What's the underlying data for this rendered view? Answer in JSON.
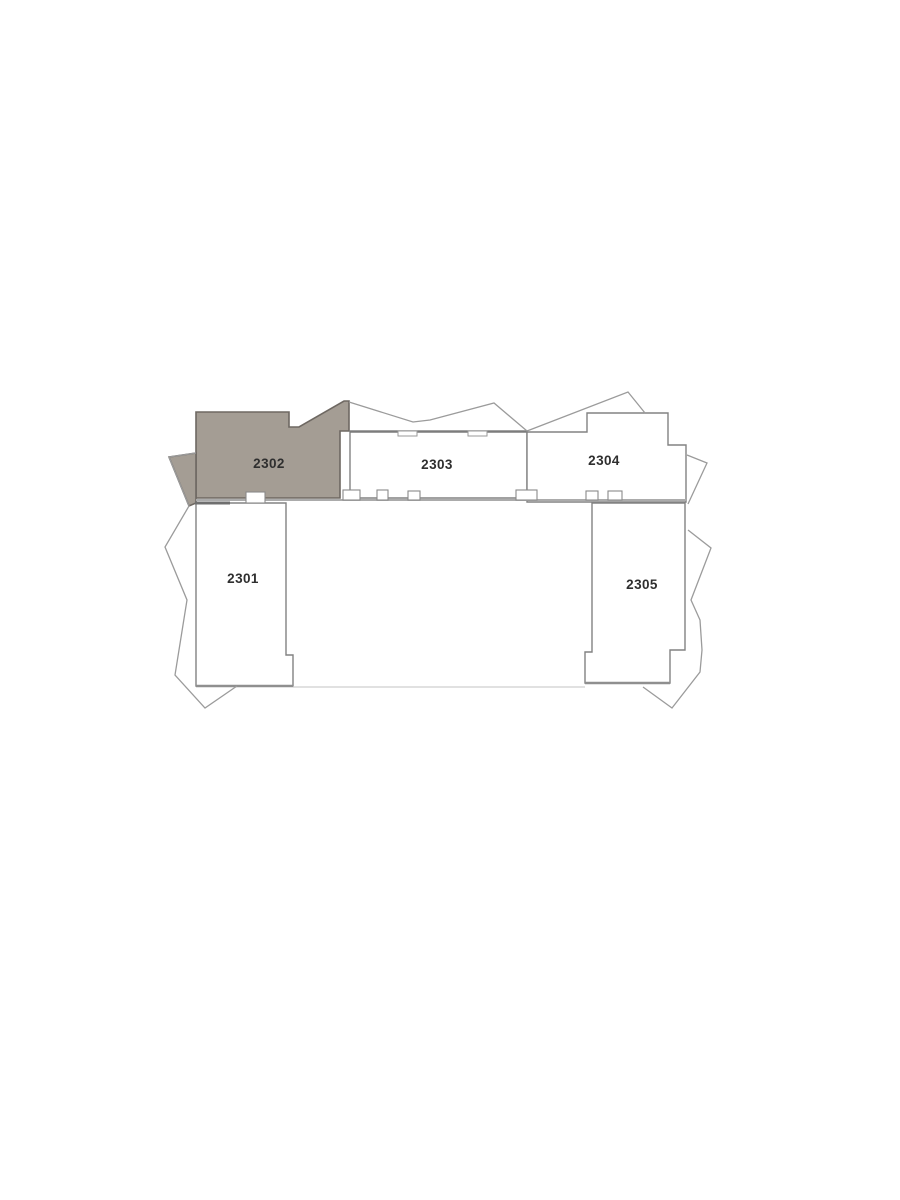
{
  "plan": {
    "name": "Floor plan — level 23 unit map",
    "highlight": {
      "unit": "2302",
      "color": "#a49d94"
    },
    "colors": {
      "background": "#ffffff",
      "wall": "#828282",
      "balcony_line": "#9b9b9b",
      "label_text": "#2f2f2f"
    },
    "units": [
      {
        "label": "2301",
        "highlighted": false
      },
      {
        "label": "2302",
        "highlighted": true
      },
      {
        "label": "2303",
        "highlighted": false
      },
      {
        "label": "2304",
        "highlighted": false
      },
      {
        "label": "2305",
        "highlighted": false
      }
    ]
  }
}
